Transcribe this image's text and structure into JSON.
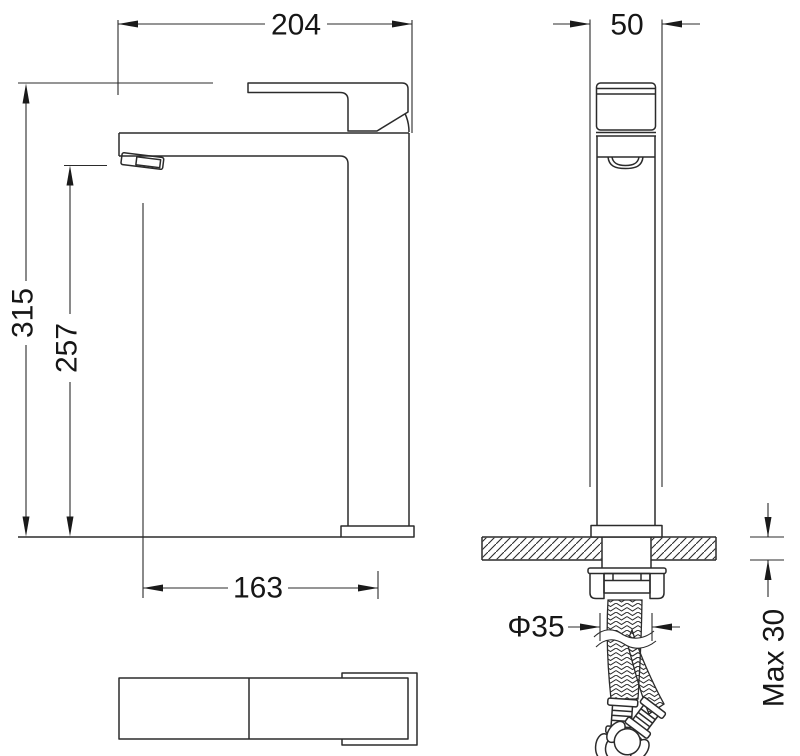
{
  "drawing": {
    "type": "technical-dimension-drawing",
    "subject": "tall basin mixer tap with mounting hoses",
    "units": "mm",
    "colors": {
      "line": "#2b2b2b",
      "background": "#ffffff",
      "text": "#161616"
    },
    "views": {
      "side_view": "side elevation",
      "front_view": "front elevation with countertop section",
      "top_view": "plan view"
    },
    "dimensions": {
      "spout_overall_length": "204",
      "body_width": "50",
      "overall_height": "315",
      "outlet_height": "257",
      "spout_reach": "163",
      "hole_diameter": "Φ35",
      "max_counter_thickness": "Max 30"
    }
  }
}
